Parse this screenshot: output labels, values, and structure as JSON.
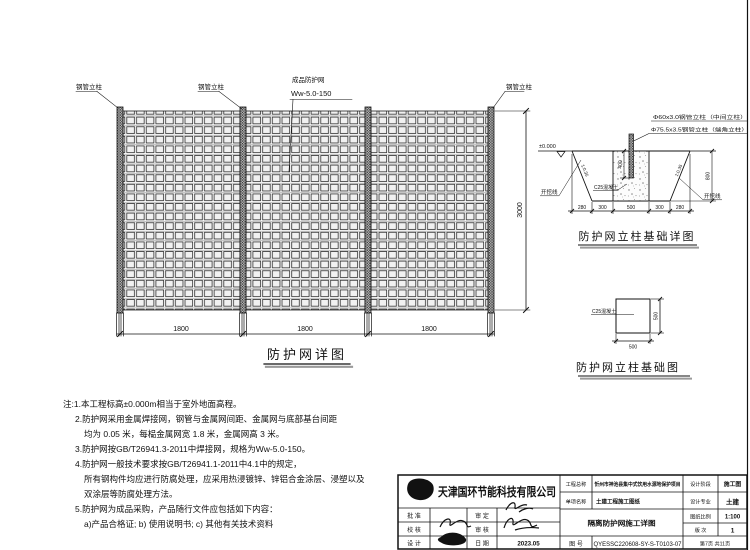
{
  "fence": {
    "title": "防护网详图",
    "post_label_1": "钢管立柱",
    "post_label_2": "钢管立柱",
    "post_label_3": "钢管立柱",
    "mesh_label_line1": "成品防护网",
    "mesh_label_line2": "Ww-5.0-150",
    "dim_panel_1": "1800",
    "dim_panel_2": "1800",
    "dim_panel_3": "1800",
    "dim_height": "3000"
  },
  "foundation_detail": {
    "title": "防护网立柱基础详图",
    "label_mid_post": "Φ60x3.0钢管立柱（中间立柱）",
    "label_end_post": "Φ75.5x3.5钢管立柱（端角立柱）",
    "label_level": "±0.000",
    "label_excavation_left": "开挖线",
    "label_excavation_right": "开挖线",
    "label_slope_left": "1:0.35",
    "label_slope_right": "1:0.35",
    "label_concrete": "C25混凝土",
    "dim_embed": "400",
    "dim_depth": "800",
    "dim_b1": "280",
    "dim_b2": "300",
    "dim_b3": "500",
    "dim_b4": "300",
    "dim_b5": "280"
  },
  "foundation_plan": {
    "title": "防护网立柱基础图",
    "label_concrete": "C25混凝土",
    "dim_w": "500",
    "dim_h": "500"
  },
  "notes": {
    "l1": "注:1.本工程标高±0.000m相当于室外地面高程。",
    "l2": "2.防护网采用金属焊接网，钢管与金属网间距、金属网与底部基台间距",
    "l3": "均为 0.05 米，每榀金属网宽 1.8 米，金属网高 3 米。",
    "l4": "3.防护网按GB/T26941.3-2011中焊接网，规格为Ww-5.0-150。",
    "l5": "4.防护网一般技术要求按GB/T26941.1-2011中4.1中的规定，",
    "l6": "所有钢构件均应进行防腐处理，应采用热浸镀锌、锌铝合金涂层、浸塑以及",
    "l7": "双涂层等防腐处理方法。",
    "l8": "5.防护网为成品采购，产品随行文件应包括如下内容：",
    "l9": "a)产品合格证; b) 使用说明书; c) 其他有关技术资料"
  },
  "titleblock": {
    "company": "天津国环节能科技有限公司",
    "label_project": "工程总称",
    "value_project": "忻州市神池县集中式饮用水源地保护项目",
    "label_item": "单项名称",
    "value_item": "土建工程施工图纸",
    "drawing_name": "隔离防护网施工详图",
    "label_drawing_no": "图 号",
    "value_drawing_no": "QYESSC220608-SY-S-T0103-07",
    "label_stage": "设计阶段",
    "value_stage": "施工图",
    "label_discipline": "设计专业",
    "value_discipline": "土建",
    "label_scale": "图纸比例",
    "value_scale": "1:100",
    "label_revision": "版 次",
    "value_revision": "1",
    "page_info": "第7页 共11页",
    "label_approve": "批 准",
    "label_verify": "审 定",
    "label_check": "校 核",
    "label_review": "审 核",
    "label_design": "设 计",
    "label_date": "日 期",
    "value_date": "2023.05"
  }
}
